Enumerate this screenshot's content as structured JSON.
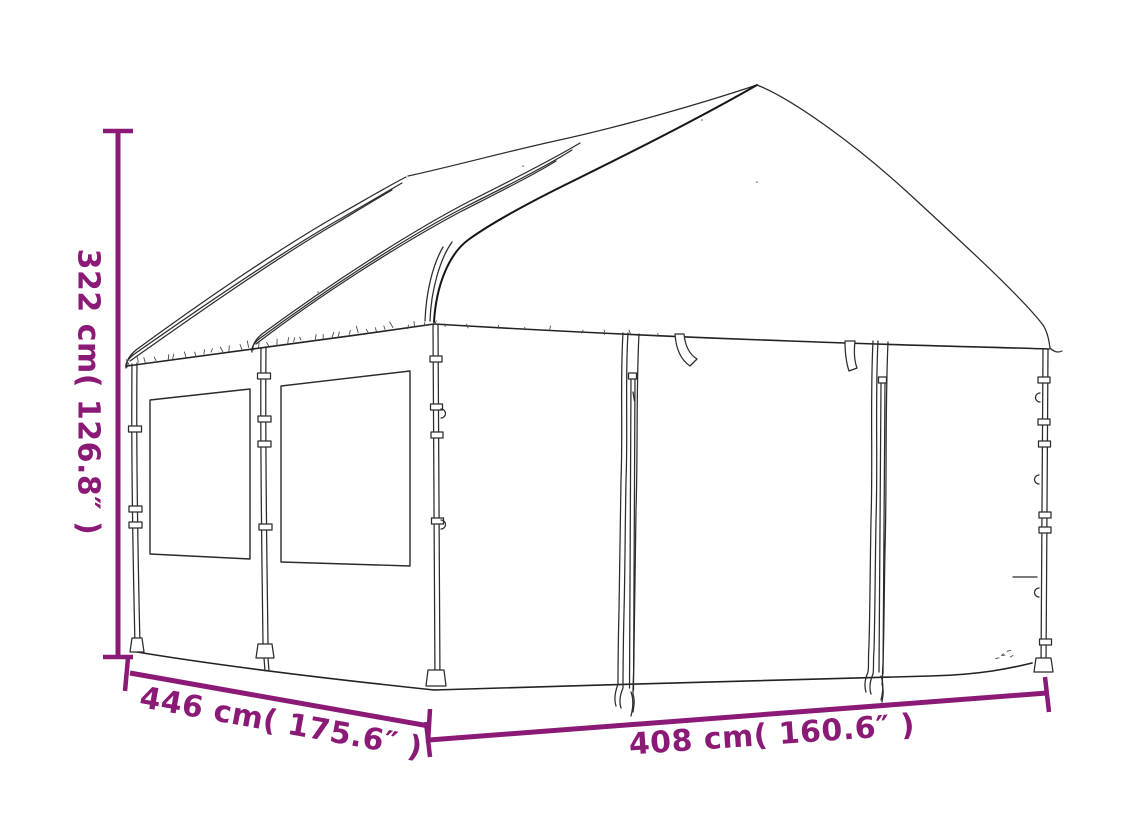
{
  "diagram": {
    "subject": "gazebo-canopy-line-drawing",
    "ink_color": "#2b2b2b",
    "dimension_color": "#8a1a75",
    "dimensions": [
      {
        "id": "height",
        "label": "322 cm( 126.8″ )",
        "orientation": "vertical-left"
      },
      {
        "id": "depth",
        "label": "446 cm( 175.6″ )",
        "orientation": "diagonal-bottom-left"
      },
      {
        "id": "width",
        "label": "408 cm( 160.6″ )",
        "orientation": "horizontal-bottom-right"
      }
    ]
  }
}
